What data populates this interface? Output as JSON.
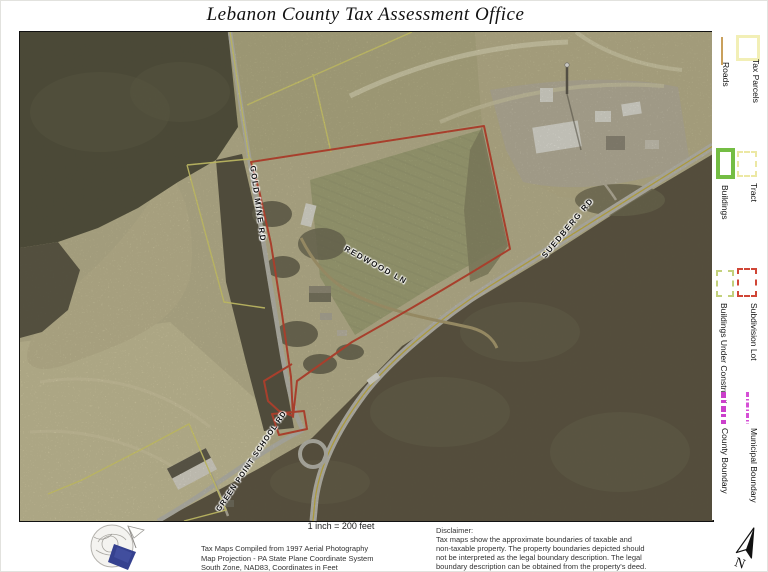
{
  "title": "Lebanon County Tax Assessment Office",
  "legend": {
    "items": [
      {
        "label": "Tax Parcels",
        "symbol": "solid-rect-outline",
        "color": "#f2efb6"
      },
      {
        "label": "Roads",
        "symbol": "solid-line",
        "color": "#c9a05c"
      },
      {
        "label": "Tract",
        "symbol": "dashed-rect-outline",
        "color": "#ece8a4"
      },
      {
        "label": "Buildings",
        "symbol": "thick-rect-outline",
        "color": "#74bd44"
      },
      {
        "label": "Subdivision Lot",
        "symbol": "dashed-rect-outline",
        "color": "#d04636"
      },
      {
        "label": "Buildings Under Construction",
        "symbol": "dashed-rect-outline",
        "color": "#c3d17c"
      },
      {
        "label": "Municipal Boundary",
        "symbol": "dash-dot-line",
        "color": "#d64fd6"
      },
      {
        "label": "County Boundary",
        "symbol": "thick-dashed-line",
        "color": "#cb3fcb"
      }
    ]
  },
  "map": {
    "road_labels": [
      "GOLD MINE RD",
      "REDWOOD LN",
      "SUEDBERG RD",
      "GREEN POINT SCHOOL RD"
    ],
    "scale_text": "1 inch = 200 feet",
    "parcel_outline_color": "#ce3b28",
    "tax_parcel_line_color": "#e7e272"
  },
  "footer": {
    "compilation_lines": [
      "Tax Maps Compiled from 1997 Aerial Photography",
      "Map Projection - PA State Plane Coordinate System",
      "South Zone, NAD83, Coordinates in Feet"
    ],
    "disclaimer_title": "Disclaimer:",
    "disclaimer_lines": [
      "Tax maps show the approximate boundaries of taxable and",
      "non-taxable property.  The property boundaries depicted should",
      "not be interpreted as the legal boundary description.  The legal",
      "boundary description can be obtained from the property's deed."
    ],
    "north_label": "N"
  }
}
